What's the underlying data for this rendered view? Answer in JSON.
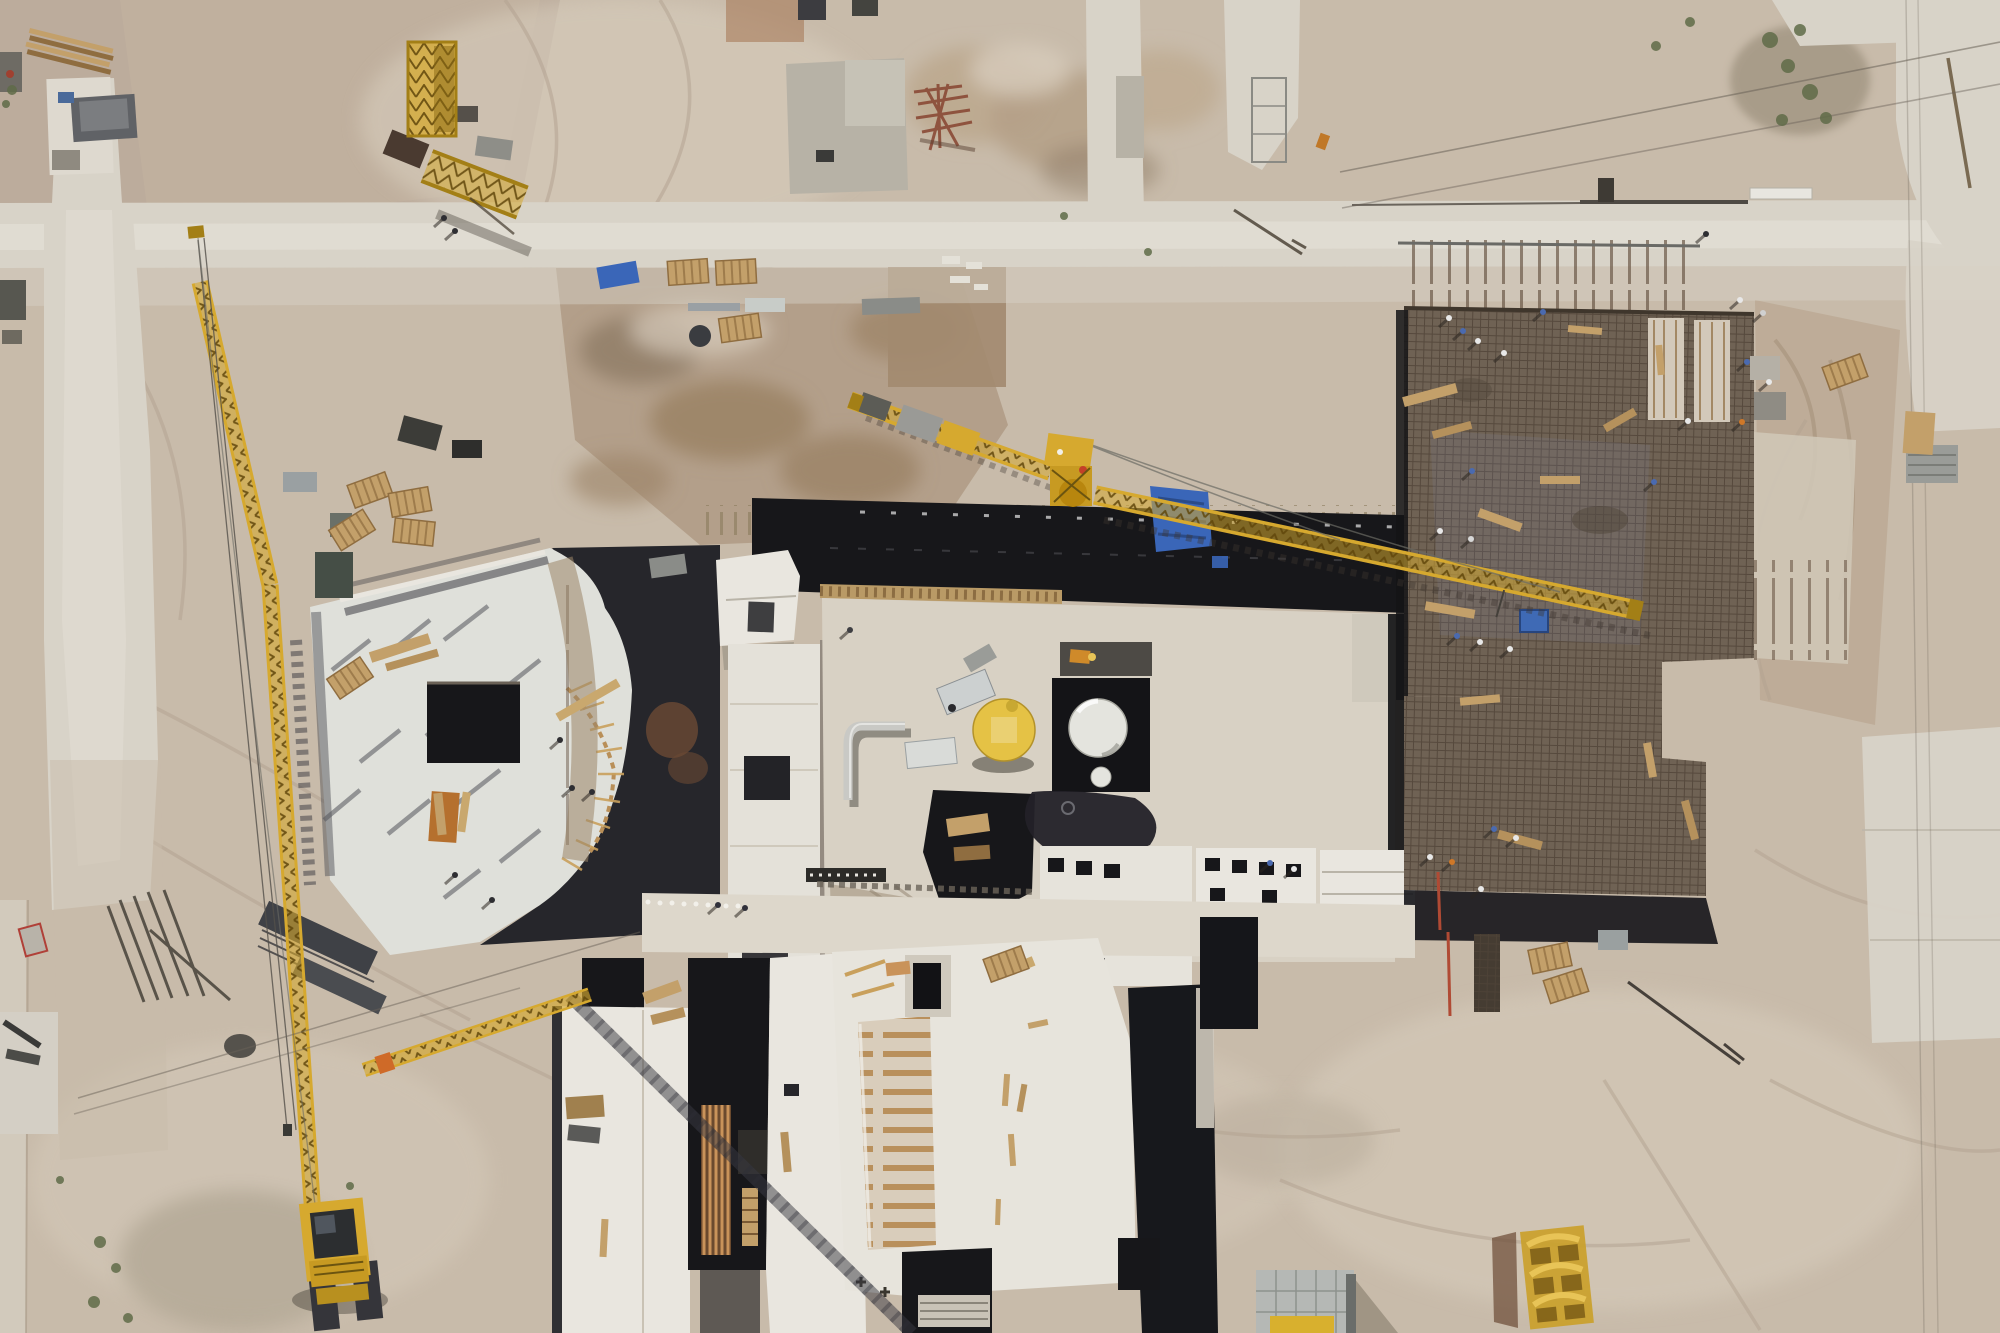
{
  "scene": {
    "type": "aerial-drone-photograph",
    "description": "Top-down aerial drone photograph of a large sandy construction site. A central concrete building under construction carries a yellow circular dome and a white storage tank; a curved-slab building sits at the left beside a tall yellow crawler-crane boom; a large brown rebar deck with many workers occupies the right; a yellow tower-crane jib crosses the middle; concrete access roads cross the sand with scattered pallets, formwork, blue tarps, containers and spoil piles.",
    "camera": "nadir (straight down) view, midday hard shadows"
  },
  "palette": {
    "sand": "#c8bbaa",
    "sandLight": "#d7ccbc",
    "sandDark": "#b2a190",
    "sandPink": "#c3b2a0",
    "dirt": "#a8937b",
    "dirtDark": "#8f7c66",
    "road": "#d8d3c8",
    "roadBright": "#e2ddd3",
    "slab": "#e9e6df",
    "slabBlue": "#dfe0da",
    "slabDim": "#cfc9bc",
    "concrete": "#b7b2a6",
    "shadow": "#3a3a42",
    "black": "#17171a",
    "deck": "#6f6254",
    "deckLine": "#53463a",
    "deckBlue": "#7d87a0",
    "yellow": "#d6a92f",
    "yellowDark": "#a37f16",
    "yellowBright": "#e8c457",
    "domeYellow": "#e5c245",
    "tank": "#e4e4de",
    "white": "#f0efe9",
    "blue": "#3a66b8",
    "blueDark": "#27457e",
    "rust": "#8a4a36",
    "wood": "#c3a06a",
    "woodDark": "#8f6d40",
    "woodOrange": "#b5702e",
    "green": "#5f6b48",
    "steel": "#c9c9c5",
    "gray": "#9a9c98",
    "darkGray": "#55565a"
  },
  "objects": {
    "cranes": [
      {
        "name": "crawler-crane",
        "note": "tall lattice boom, bottom left"
      },
      {
        "name": "tower-crane",
        "note": "jib crosses centre toward rebar deck"
      },
      {
        "name": "dismantled-crane-parts",
        "note": "mast section and jib piece, top left"
      }
    ],
    "buildings": [
      {
        "name": "curved-slab-building",
        "note": "left of centre"
      },
      {
        "name": "central-building",
        "note": "dark formwork roof, yellow dome, white tank"
      },
      {
        "name": "rebar-deck",
        "note": "brown reinforcement mesh slab, right"
      },
      {
        "name": "lower-building-cluster",
        "note": "white roof slabs, bottom centre"
      }
    ],
    "workers_visible": 27,
    "roads": [
      "horizontal site road",
      "left access road",
      "two stub roads top centre",
      "L-shaped road top right",
      "pads bottom right"
    ]
  },
  "stamps": {
    "people": [
      {
        "x": 444,
        "y": 218,
        "c": "#2e2e32"
      },
      {
        "x": 455,
        "y": 231,
        "c": "#2e2e32"
      },
      {
        "x": 1706,
        "y": 234,
        "c": "#2e2e32"
      },
      {
        "x": 850,
        "y": 630,
        "c": "#3e3e42"
      },
      {
        "x": 560,
        "y": 740,
        "c": "#2e2e32"
      },
      {
        "x": 572,
        "y": 788,
        "c": "#2e2e32"
      },
      {
        "x": 592,
        "y": 792,
        "c": "#2e2e32"
      },
      {
        "x": 455,
        "y": 875,
        "c": "#2e2e32"
      },
      {
        "x": 492,
        "y": 900,
        "c": "#2e2e32"
      },
      {
        "x": 718,
        "y": 905,
        "c": "#30303a"
      },
      {
        "x": 745,
        "y": 908,
        "c": "#30303a"
      },
      {
        "x": 1449,
        "y": 318,
        "c": "#e8e8e8"
      },
      {
        "x": 1463,
        "y": 331,
        "c": "#4a6ab0"
      },
      {
        "x": 1478,
        "y": 341,
        "c": "#e8e8e8"
      },
      {
        "x": 1504,
        "y": 353,
        "c": "#e8e8e8"
      },
      {
        "x": 1543,
        "y": 312,
        "c": "#4a6ab0"
      },
      {
        "x": 1740,
        "y": 300,
        "c": "#e8e8e8"
      },
      {
        "x": 1763,
        "y": 313,
        "c": "#d0d0d0"
      },
      {
        "x": 1747,
        "y": 362,
        "c": "#4a6ab0"
      },
      {
        "x": 1769,
        "y": 382,
        "c": "#e8e8e8"
      },
      {
        "x": 1742,
        "y": 422,
        "c": "#cf7828"
      },
      {
        "x": 1688,
        "y": 421,
        "c": "#e8e8e8"
      },
      {
        "x": 1654,
        "y": 482,
        "c": "#4a6ab0"
      },
      {
        "x": 1472,
        "y": 471,
        "c": "#4a6ab0"
      },
      {
        "x": 1440,
        "y": 531,
        "c": "#e8e8e8"
      },
      {
        "x": 1471,
        "y": 539,
        "c": "#d8d8d8"
      },
      {
        "x": 1457,
        "y": 636,
        "c": "#4a6ab0"
      },
      {
        "x": 1480,
        "y": 642,
        "c": "#e8e8e8"
      },
      {
        "x": 1510,
        "y": 649,
        "c": "#e8e8e8"
      },
      {
        "x": 1494,
        "y": 829,
        "c": "#4a6ab0"
      },
      {
        "x": 1516,
        "y": 838,
        "c": "#e8e8e8"
      },
      {
        "x": 1481,
        "y": 889,
        "c": "#e8e8e8"
      },
      {
        "x": 1270,
        "y": 863,
        "c": "#4a6ab0"
      },
      {
        "x": 1294,
        "y": 869,
        "c": "#e8e8e8"
      },
      {
        "x": 1430,
        "y": 857,
        "c": "#e8e8e8"
      },
      {
        "x": 1452,
        "y": 862,
        "c": "#cf7828"
      }
    ],
    "planks": [
      {
        "x": 1430,
        "y": 395,
        "w": 55,
        "h": 10,
        "r": -15,
        "c": "#c3a06a"
      },
      {
        "x": 1452,
        "y": 430,
        "w": 40,
        "h": 8,
        "r": -15,
        "c": "#b5915c"
      },
      {
        "x": 1500,
        "y": 520,
        "w": 45,
        "h": 9,
        "r": 20,
        "c": "#c3a06a"
      },
      {
        "x": 1560,
        "y": 480,
        "w": 40,
        "h": 8,
        "r": 0,
        "c": "#c3a06a"
      },
      {
        "x": 1620,
        "y": 420,
        "w": 35,
        "h": 8,
        "r": -30,
        "c": "#b5915c"
      },
      {
        "x": 1450,
        "y": 610,
        "w": 50,
        "h": 9,
        "r": 10,
        "c": "#c3a06a"
      },
      {
        "x": 1480,
        "y": 700,
        "w": 40,
        "h": 8,
        "r": -5,
        "c": "#c3a06a"
      },
      {
        "x": 1520,
        "y": 840,
        "w": 45,
        "h": 9,
        "r": 15,
        "c": "#b5915c"
      },
      {
        "x": 1650,
        "y": 760,
        "w": 35,
        "h": 8,
        "r": 80,
        "c": "#c3a06a"
      },
      {
        "x": 1690,
        "y": 820,
        "w": 40,
        "h": 8,
        "r": 75,
        "c": "#b5915c"
      },
      {
        "x": 1660,
        "y": 360,
        "w": 30,
        "h": 7,
        "r": 85,
        "c": "#c3a06a"
      },
      {
        "x": 1585,
        "y": 330,
        "w": 34,
        "h": 7,
        "r": 5,
        "c": "#c3a06a"
      },
      {
        "x": 400,
        "y": 648,
        "w": 62,
        "h": 11,
        "r": -18,
        "c": "#c3a06a"
      },
      {
        "x": 412,
        "y": 660,
        "w": 54,
        "h": 8,
        "r": -16,
        "c": "#b5915c"
      },
      {
        "x": 588,
        "y": 700,
        "w": 70,
        "h": 9,
        "r": -30,
        "c": "#c9a86e"
      },
      {
        "x": 440,
        "y": 814,
        "w": 9,
        "h": 42,
        "r": -6,
        "c": "#c3a06a"
      },
      {
        "x": 452,
        "y": 818,
        "w": 9,
        "h": 46,
        "r": 3,
        "c": "#b5702e"
      },
      {
        "x": 464,
        "y": 812,
        "w": 8,
        "h": 40,
        "r": 8,
        "c": "#c9a86e"
      },
      {
        "x": 1006,
        "y": 1090,
        "w": 6,
        "h": 32,
        "r": 4,
        "c": "#c3a06a"
      },
      {
        "x": 1022,
        "y": 1098,
        "w": 6,
        "h": 28,
        "r": 10,
        "c": "#b5915c"
      },
      {
        "x": 1012,
        "y": 1150,
        "w": 6,
        "h": 32,
        "r": -4,
        "c": "#c3a06a"
      },
      {
        "x": 998,
        "y": 1212,
        "w": 5,
        "h": 26,
        "r": 2,
        "c": "#c3a06a"
      },
      {
        "x": 1038,
        "y": 1024,
        "w": 20,
        "h": 6,
        "r": -12,
        "c": "#c3a06a"
      },
      {
        "x": 1016,
        "y": 968,
        "w": 38,
        "h": 10,
        "r": -22,
        "c": "#c9a86e"
      },
      {
        "x": 662,
        "y": 992,
        "w": 38,
        "h": 12,
        "r": -20,
        "c": "#c3a06a"
      },
      {
        "x": 668,
        "y": 1016,
        "w": 34,
        "h": 10,
        "r": -14,
        "c": "#b5915c"
      },
      {
        "x": 604,
        "y": 1238,
        "w": 7,
        "h": 38,
        "r": 3,
        "c": "#c3a06a"
      },
      {
        "x": 786,
        "y": 1152,
        "w": 8,
        "h": 40,
        "r": -5,
        "c": "#b5915c"
      }
    ],
    "pallets": [
      {
        "x": 370,
        "y": 490,
        "r": -20
      },
      {
        "x": 410,
        "y": 502,
        "r": -10
      },
      {
        "x": 352,
        "y": 530,
        "r": -32
      },
      {
        "x": 414,
        "y": 532,
        "r": 6
      },
      {
        "x": 350,
        "y": 678,
        "r": -34
      },
      {
        "x": 688,
        "y": 272,
        "r": -4
      },
      {
        "x": 736,
        "y": 272,
        "r": -3
      },
      {
        "x": 740,
        "y": 328,
        "r": -8
      },
      {
        "x": 1845,
        "y": 372,
        "r": -20
      },
      {
        "x": 1550,
        "y": 958,
        "r": -12
      },
      {
        "x": 1566,
        "y": 986,
        "r": -18
      },
      {
        "x": 1006,
        "y": 964,
        "r": -20
      }
    ],
    "shrubs": [
      {
        "x": 12,
        "y": 90,
        "s": 5
      },
      {
        "x": 6,
        "y": 104,
        "s": 4
      },
      {
        "x": 100,
        "y": 1242,
        "s": 6
      },
      {
        "x": 116,
        "y": 1268,
        "s": 5
      },
      {
        "x": 94,
        "y": 1302,
        "s": 6
      },
      {
        "x": 128,
        "y": 1318,
        "s": 5
      },
      {
        "x": 350,
        "y": 1186,
        "s": 4
      },
      {
        "x": 60,
        "y": 1180,
        "s": 4
      },
      {
        "x": 1770,
        "y": 40,
        "s": 8
      },
      {
        "x": 1788,
        "y": 66,
        "s": 7
      },
      {
        "x": 1810,
        "y": 92,
        "s": 8
      },
      {
        "x": 1826,
        "y": 118,
        "s": 6
      },
      {
        "x": 1782,
        "y": 120,
        "s": 6
      },
      {
        "x": 1800,
        "y": 30,
        "s": 6
      },
      {
        "x": 1656,
        "y": 46,
        "s": 5
      },
      {
        "x": 1690,
        "y": 22,
        "s": 5
      },
      {
        "x": 1064,
        "y": 216,
        "s": 4
      },
      {
        "x": 1148,
        "y": 252,
        "s": 4
      }
    ]
  }
}
